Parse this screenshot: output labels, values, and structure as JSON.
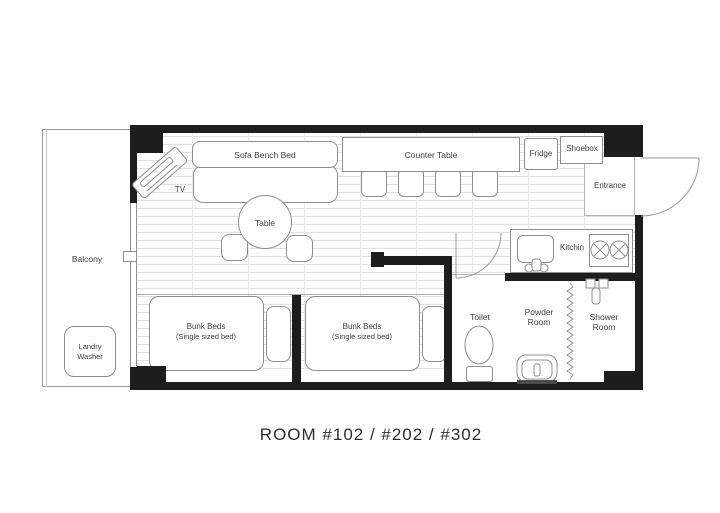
{
  "title": "ROOM #102 / #202 / #302",
  "colors": {
    "wall": "#1d1d1d",
    "furniture_outline": "#8e8e8e",
    "floor_line": "#e0e0e0",
    "text": "#3c3c3c"
  },
  "rooms": {
    "balcony": "Balcony",
    "entrance": "Entrance",
    "kitchen": "Kitchin",
    "toilet": "Toilet",
    "powder_room_line1": "Powder",
    "powder_room_line2": "Room",
    "shower_room_line1": "Shower",
    "shower_room_line2": "Room"
  },
  "furniture": {
    "tv": "TV",
    "sofa_bench_bed": "Sofa Bench Bed",
    "counter_table": "Counter Table",
    "fridge": "Fridge",
    "shoebox": "Shoebox",
    "table": "Table",
    "laundry_line1": "Landry",
    "laundry_line2": "Washer",
    "bunk1_line1": "Bunk Beds",
    "bunk1_line2": "(Single sized bed)",
    "bunk2_line1": "Bunk Beds",
    "bunk2_line2": "(Single sized bed)"
  },
  "icons": [
    "tv-unit-icon",
    "entrance-door-arc-icon",
    "bath-door-arc-icon",
    "toilet-bowl-icon",
    "washbasin-icon",
    "stove-burners-icon",
    "sink-faucet-icon",
    "shower-mixer-icon",
    "accordion-divider-icon",
    "window-handle-icon"
  ]
}
